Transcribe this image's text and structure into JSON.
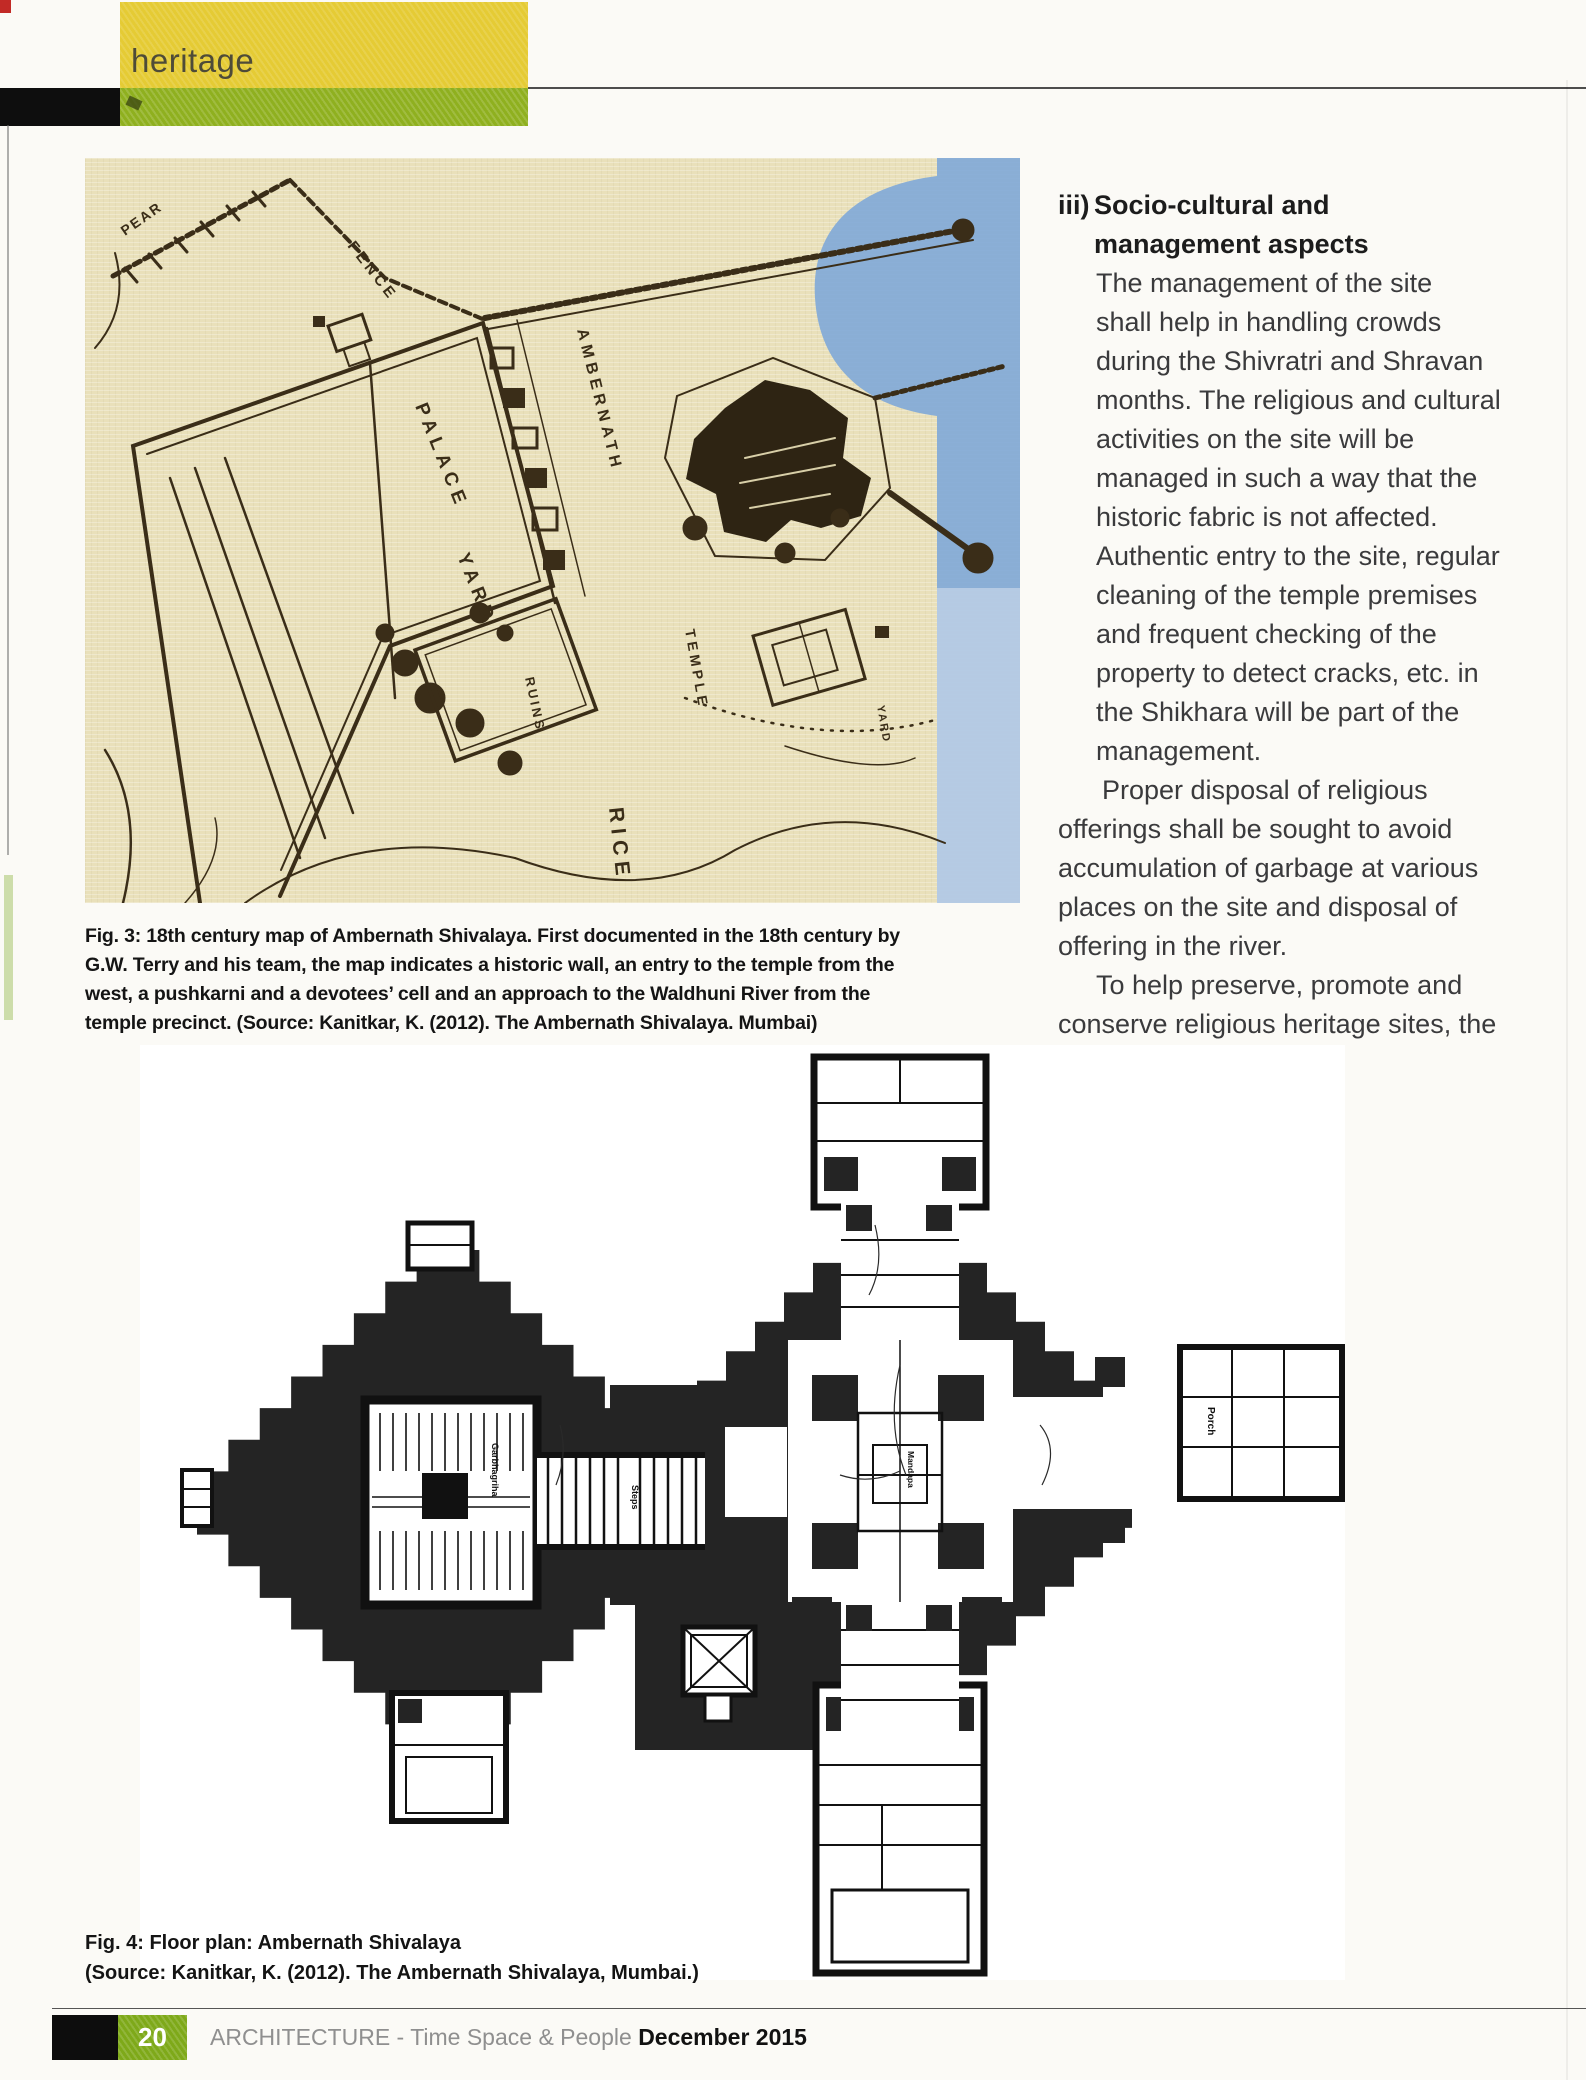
{
  "header": {
    "section_label": "heritage"
  },
  "colors": {
    "banner_yellow": "#e5cb34",
    "banner_green": "#8fb01f",
    "corner_red": "#c22a26",
    "map_paper": "#e9e0ba",
    "map_ink": "#3a2d18",
    "map_blue": "#7fa8d8",
    "plan_black": "#242424"
  },
  "article": {
    "heading_num": "iii)",
    "heading_line1": "Socio-cultural and",
    "heading_line2": "management aspects",
    "body_lines": [
      "The management of the site",
      "shall help in handling crowds",
      "during the Shivratri and Shravan",
      "months. The religious and cultural",
      "activities on the site will be",
      "managed in such a way that the",
      "historic fabric is not affected.",
      "Authentic entry to the site, regular",
      "cleaning of the temple premises",
      "and frequent checking of the",
      "property to detect cracks, etc. in",
      "the Shikhara will be part of the",
      "management.",
      "Proper disposal of religious",
      "offerings shall be sought to avoid",
      "accumulation of garbage at various",
      "places on the site and disposal of",
      "offering in the river.",
      "To help preserve, promote and",
      "conserve religious heritage sites, the"
    ]
  },
  "figure3": {
    "caption_lines": [
      "Fig. 3: 18th century map of Ambernath Shivalaya. First documented in the 18th century by",
      "G.W. Terry and his team, the map indicates a historic wall, an entry to the temple from the",
      "west, a pushkarni and a devotees’ cell and an approach to the Waldhuni River from the",
      "temple precinct. (Source: Kanitkar, K. (2012). The Ambernath Shivalaya. Mumbai)"
    ],
    "map_labels": {
      "pear": "PEAR",
      "fence": "FENCE",
      "palace": "PALACE",
      "yard": "YARD",
      "ambernath": "AMBERNATH",
      "temple": "TEMPLE",
      "yard2": "YARD",
      "ruins": "RUINS",
      "rice": "RICE"
    }
  },
  "figure4": {
    "caption_lines": [
      "Fig. 4: Floor plan: Ambernath Shivalaya",
      "(Source: Kanitkar, K. (2012). The Ambernath Shivalaya, Mumbai.)"
    ],
    "plan_labels": {
      "garbhagriha": "Garbhagriha",
      "steps": "Steps",
      "mandapa": "Mandapa",
      "porch": "Porch"
    }
  },
  "footer": {
    "page_number": "20",
    "magazine_title": "ARCHITECTURE - Time Space & People",
    "issue_date": "December 2015"
  }
}
